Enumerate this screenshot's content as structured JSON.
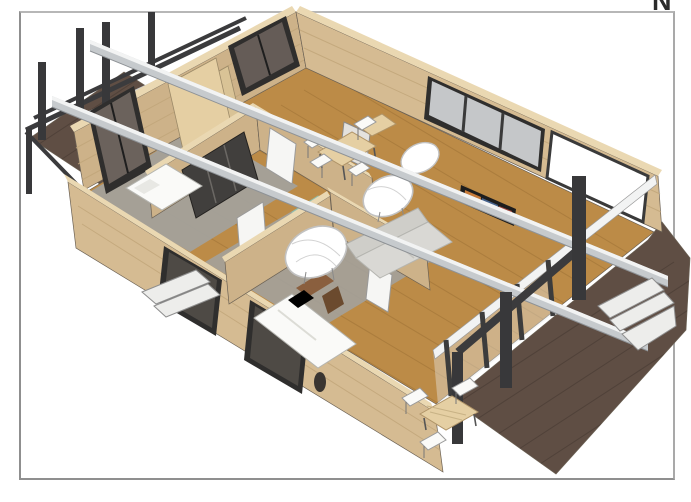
{
  "page": {
    "background": "#ffffff",
    "border_color": "#8f8f8f",
    "corner_letter": "N"
  },
  "scene": {
    "type": "3d-architectural-rendering",
    "description": "Isometric cutaway 3D rendering of a single-storey modular house with exposed grey roof beams, timber walls, a pergola deck at the west end and a second deck with outdoor dining at the east end",
    "materials": {
      "wall_wood": "#d5bb92",
      "wall_inner": "#cdb289",
      "wall_wood_light": "#ead8b2",
      "floor_wood": "#bc8b47",
      "floor_wood_line": "#9d7236",
      "carpet_gray": "#a3a19b",
      "deck_wood": "#5f4e44",
      "deck_line": "#4a3d35",
      "beam_gray": "#c6cacd",
      "beam_white": "#f2f3f3",
      "pergola_dark": "#3b3b3d",
      "glass_gray": "#c5c7c9",
      "glass_dark": "#6b625c",
      "frame_dark": "#2f2e2d",
      "furniture_white": "#fafaf8",
      "sofa_gray": "#d9d8d4",
      "shower_teal": "#a5d6c6",
      "wood_light": "#e5cfa3",
      "wood_mid": "#8a5f3e",
      "steps_white": "#ededeb"
    },
    "elements": [
      "pergola",
      "west-deck",
      "house-shell",
      "bedroom-1-bed",
      "bedroom-2-bed",
      "wardrobe",
      "bathroom-shower",
      "dining-table",
      "dining-chairs",
      "wire-lounge-chairs",
      "sofa",
      "tv",
      "roof-beams",
      "glass-doors",
      "windows",
      "east-deck",
      "outdoor-table",
      "outdoor-chairs",
      "entry-steps",
      "deck-steps"
    ]
  }
}
